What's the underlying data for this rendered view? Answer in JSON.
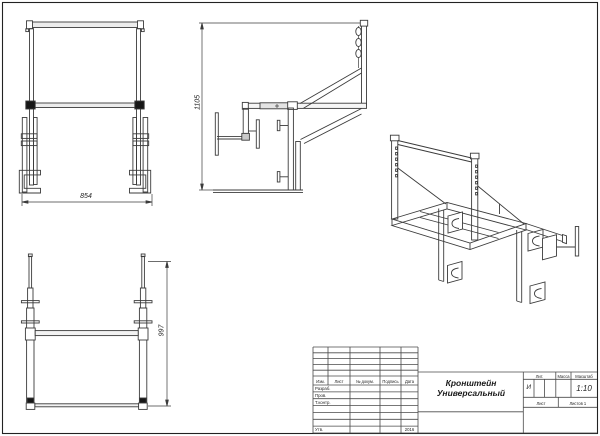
{
  "drawing": {
    "dimensions": {
      "front_width": "854",
      "side_height": "1105",
      "rear_height": "997"
    },
    "title_block": {
      "columns": {
        "izm": "Изм.",
        "list": "Лист",
        "doc": "№ докум.",
        "sign": "Подпись",
        "date": "Дата"
      },
      "rows": {
        "developer": "Разраб.",
        "checker": "Пров.",
        "tcontrol": "Т.контр.",
        "approver": "Утв."
      },
      "year": "2016",
      "title_line1": "Кронштейн",
      "title_line2": "Универсальный",
      "lit_label": "Лит.",
      "lit_value": "И",
      "mass_label": "Масса",
      "scale_label": "Масштаб",
      "scale_value": "1:10",
      "sheet_label": "Лист",
      "sheets_label": "Листов 1"
    }
  }
}
